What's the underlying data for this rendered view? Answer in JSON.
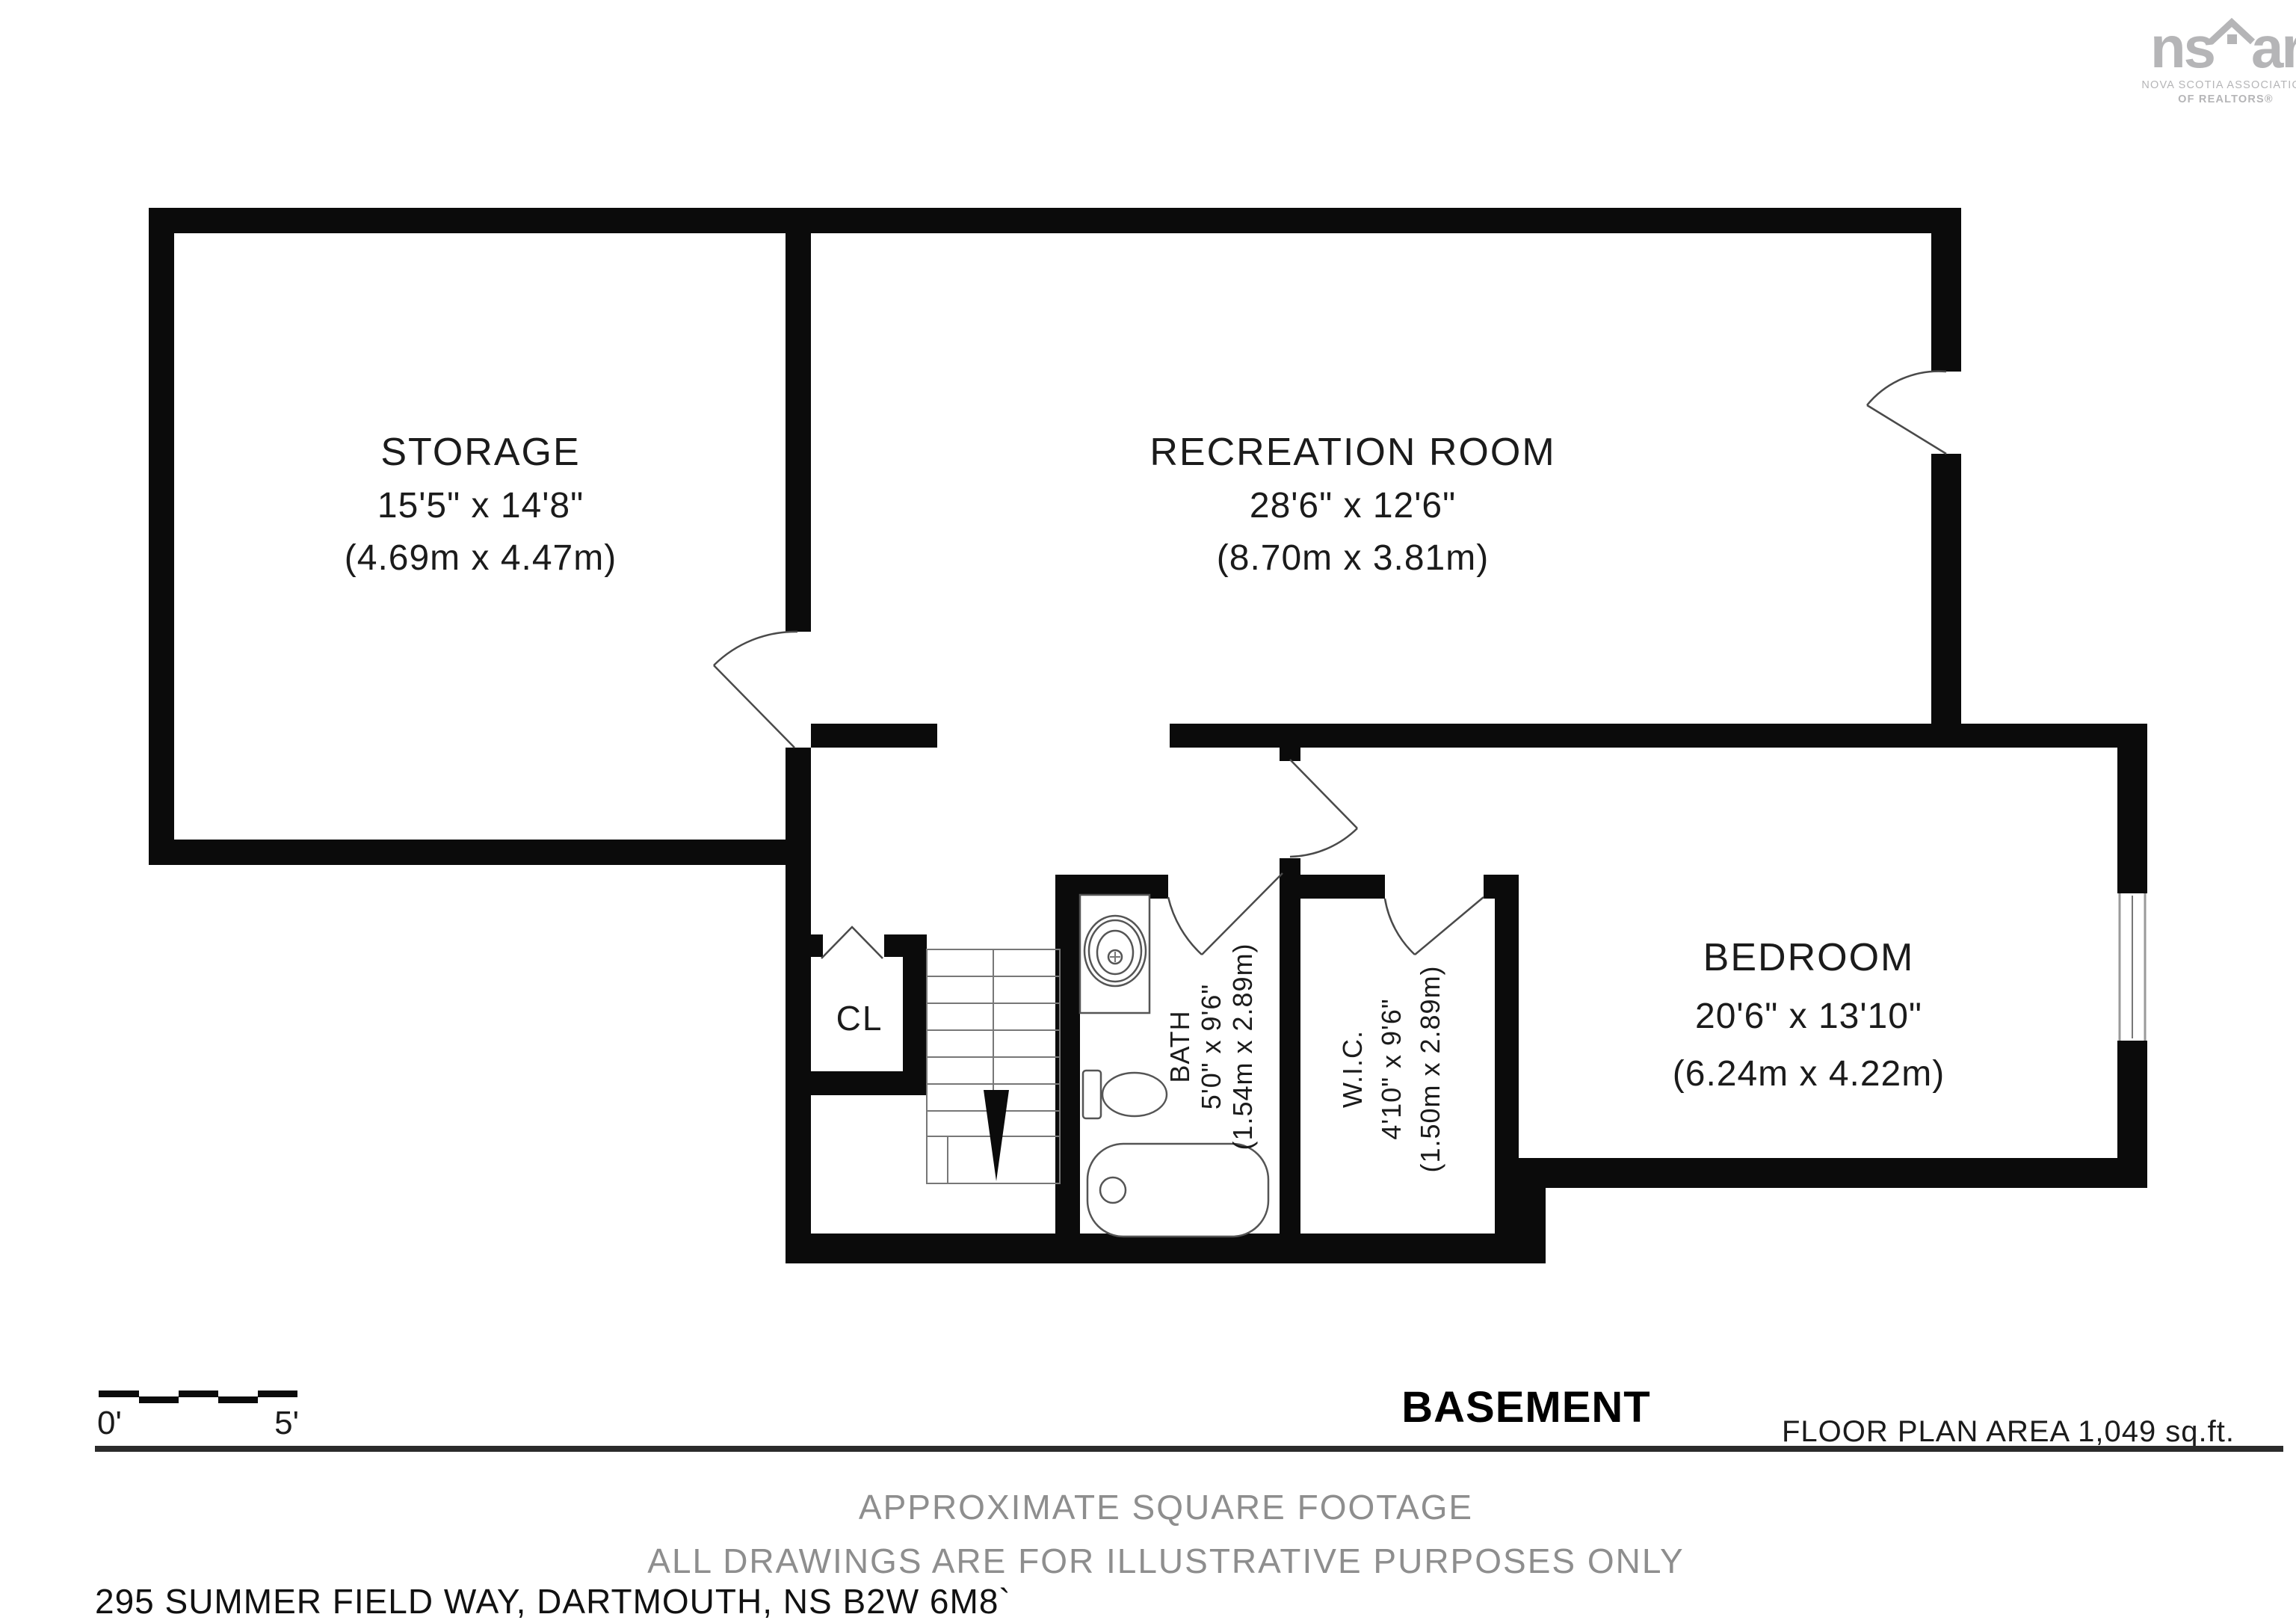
{
  "logo": {
    "brand_left": "ns",
    "brand_right": "ar",
    "sub_line1": "NOVA SCOTIA ASSOCIATION",
    "sub_line2": "OF REALTORS®"
  },
  "rooms": {
    "storage": {
      "name": "STORAGE",
      "imperial": "15'5\" x 14'8\"",
      "metric": "(4.69m x 4.47m)"
    },
    "recreation": {
      "name": "RECREATION ROOM",
      "imperial": "28'6\" x 12'6\"",
      "metric": "(8.70m x 3.81m)"
    },
    "bedroom": {
      "name": "BEDROOM",
      "imperial": "20'6\" x 13'10\"",
      "metric": "(6.24m x 4.22m)"
    },
    "bath": {
      "name": "BATH",
      "imperial": "5'0\" x 9'6\"",
      "metric": "(1.54m x 2.89m)"
    },
    "wic": {
      "name": "W.I.C.",
      "imperial": "4'10\" x 9'6\"",
      "metric": "(1.50m x 2.89m)"
    },
    "closet": {
      "name": "CL"
    }
  },
  "footer": {
    "level": "BASEMENT",
    "area": "FLOOR PLAN AREA 1,049 sq.ft.",
    "scale_start": "0'",
    "scale_end": "5'",
    "disclaimer1": "APPROXIMATE SQUARE FOOTAGE",
    "disclaimer2": "ALL DRAWINGS ARE FOR ILLUSTRATIVE PURPOSES ONLY",
    "address": "295 SUMMER FIELD WAY, DARTMOUTH, NS B2W 6M8`"
  },
  "colors": {
    "wall": "#0b0b0b",
    "line": "#4a4a4a",
    "gray_text": "#8e8e8e",
    "logo": "#b5b5b7",
    "ink": "#1b1b1b"
  }
}
